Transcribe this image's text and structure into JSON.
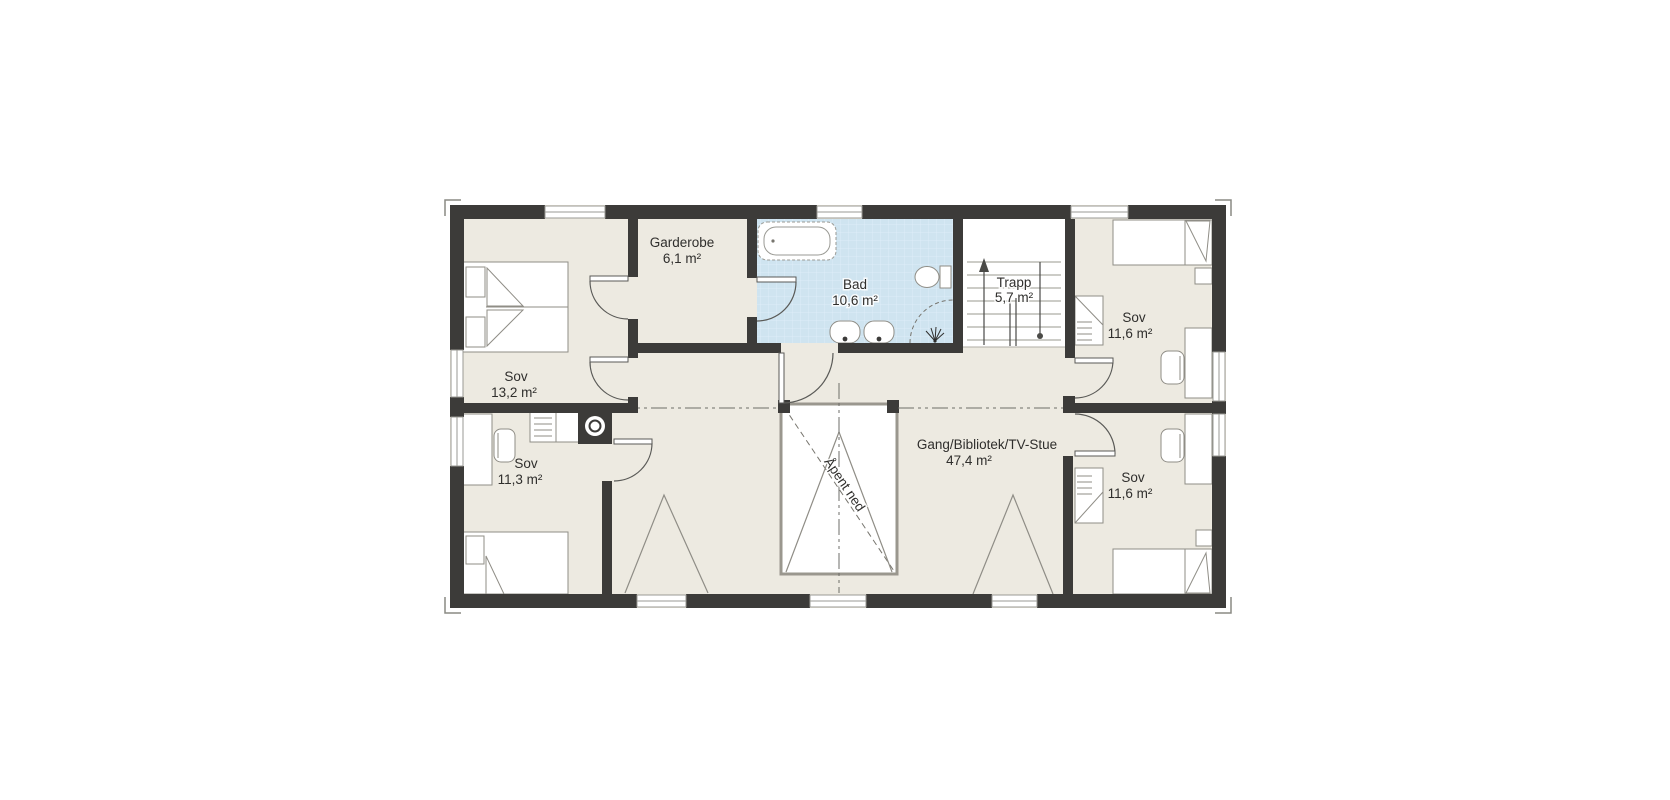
{
  "plan": {
    "rooms": [
      {
        "id": "sov-master",
        "label": "Sov",
        "area": "13,2 m²"
      },
      {
        "id": "garderobe",
        "label": "Garderobe",
        "area": "6,1 m²"
      },
      {
        "id": "bad",
        "label": "Bad",
        "area": "10,6 m²"
      },
      {
        "id": "trapp",
        "label": "Trapp",
        "area": "5,7 m²"
      },
      {
        "id": "sov-top-right",
        "label": "Sov",
        "area": "11,6 m²"
      },
      {
        "id": "sov-bottom-left",
        "label": "Sov",
        "area": "11,3 m²"
      },
      {
        "id": "gang",
        "label": "Gang/Bibliotek/TV-Stue",
        "area": "47,4 m²"
      },
      {
        "id": "sov-bottom-right",
        "label": "Sov",
        "area": "11,6 m²"
      }
    ],
    "annotations": {
      "open_below": "Åpent ned"
    },
    "colors": {
      "wall": "#3c3b39",
      "room_fill": "#edeae1",
      "bath_fill": "#cfe4f0",
      "stair_fill": "#ffffff",
      "line": "#8f8d86"
    }
  }
}
